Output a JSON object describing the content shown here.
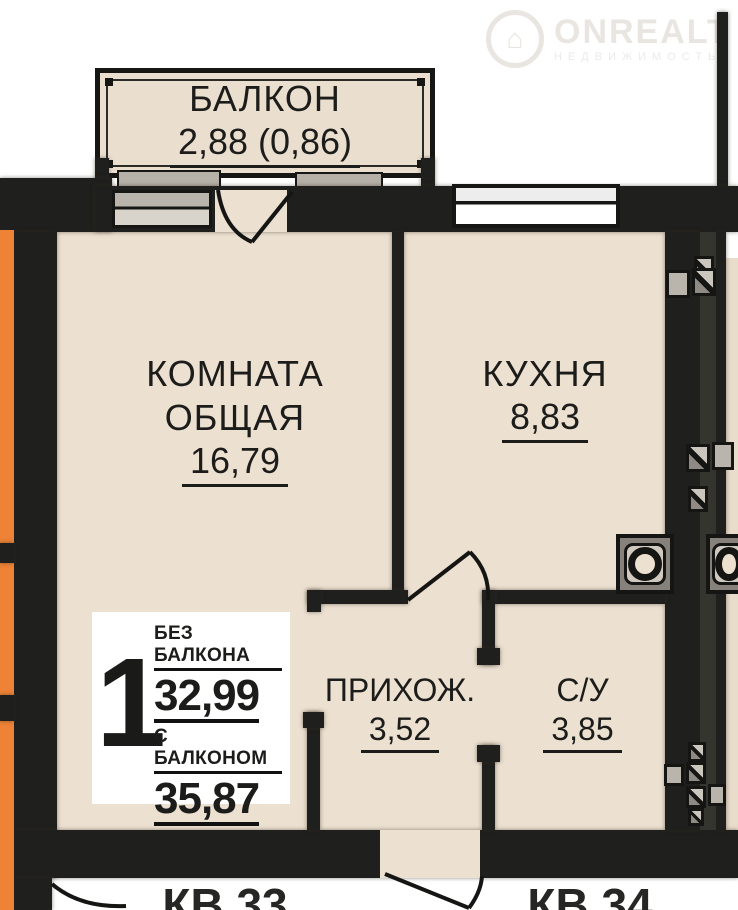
{
  "watermark": {
    "brand": "ONREALT",
    "tagline": "НЕДВИЖИМОСТЬ",
    "icon": "⌂"
  },
  "balcony": {
    "name": "БАЛКОН",
    "area": "2,88 (0,86)"
  },
  "rooms": {
    "living": {
      "name_line1": "КОМНАТА",
      "name_line2": "ОБЩАЯ",
      "area": "16,79"
    },
    "kitchen": {
      "name": "КУХНЯ",
      "area": "8,83"
    },
    "hallway": {
      "name": "ПРИХОЖ.",
      "area": "3,52"
    },
    "bathroom": {
      "name": "С/У",
      "area": "3,85"
    }
  },
  "summary": {
    "room_count": "1",
    "without_balcony_label": "БЕЗ БАЛКОНА",
    "without_balcony_area": "32,99",
    "with_balcony_label": "С БАЛКОНОМ",
    "with_balcony_area": "35,87"
  },
  "neighbors": {
    "left_unit": "КВ.33",
    "right_unit": "КВ.34"
  },
  "colors": {
    "floor": "#ece0d1",
    "wall": "#1f1f1d",
    "accent_orange": "#ee8236",
    "window_gray": "#b9b4ac",
    "background": "#ffffff"
  }
}
